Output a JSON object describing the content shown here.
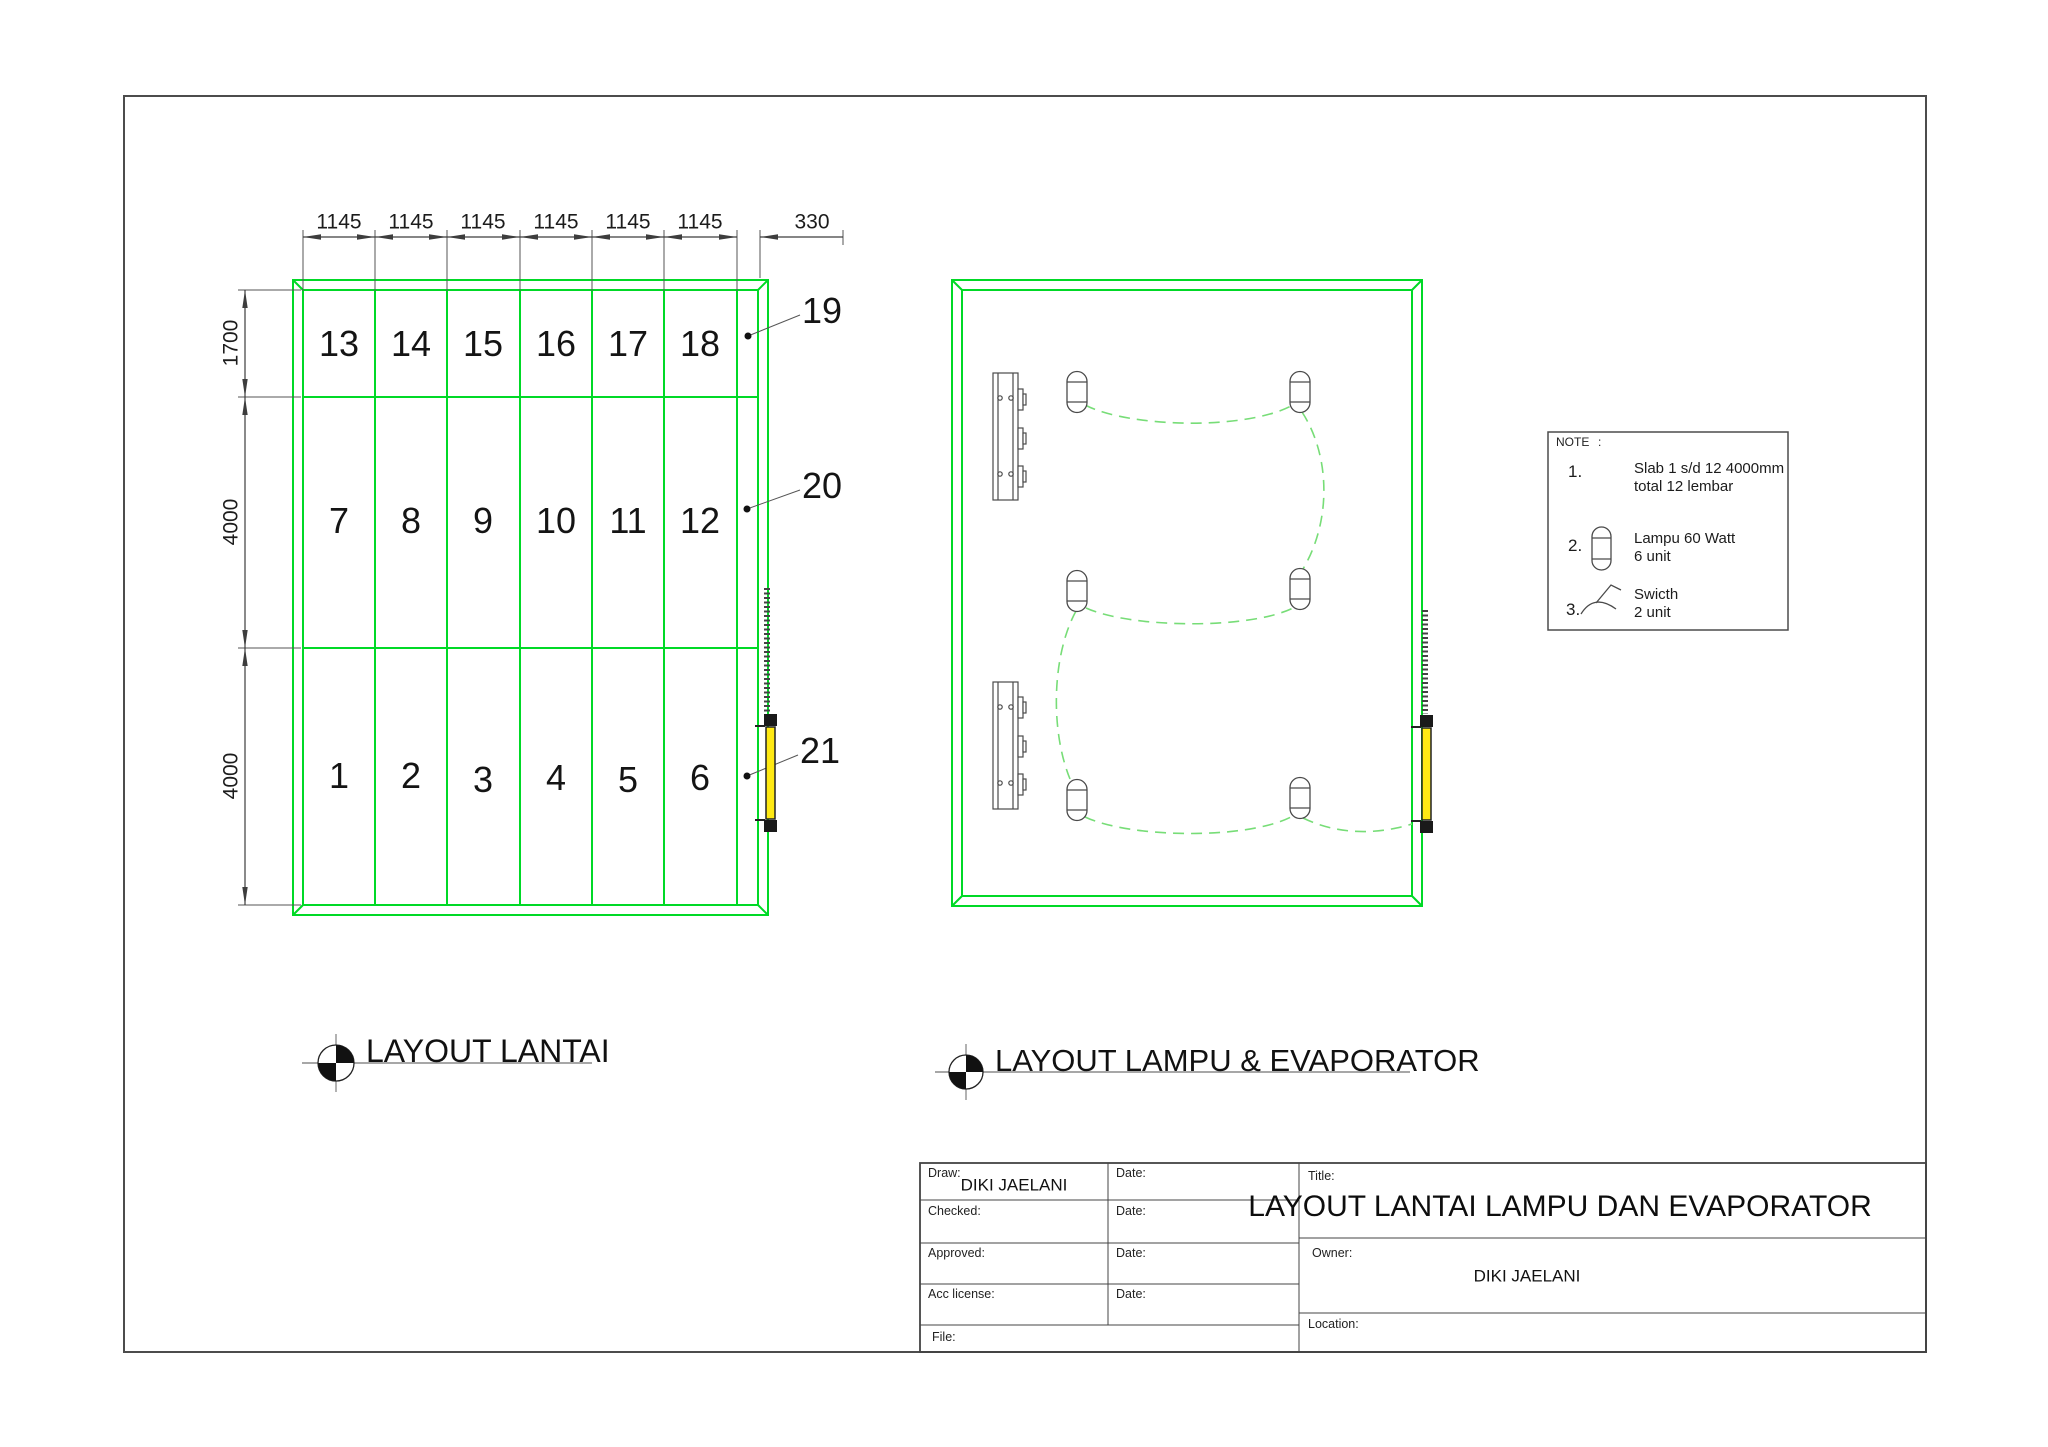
{
  "drawing1": {
    "title": "LAYOUT LANTAI",
    "top_dims": [
      "1145",
      "1145",
      "1145",
      "1145",
      "1145",
      "1145"
    ],
    "side_dim": "330",
    "left_dims": [
      "1700",
      "4000",
      "4000"
    ],
    "cells_row1": [
      "13",
      "14",
      "15",
      "16",
      "17",
      "18"
    ],
    "cells_row2": [
      "7",
      "8",
      "9",
      "10",
      "11",
      "12"
    ],
    "cells_row3": [
      "1",
      "2",
      "3",
      "4",
      "5",
      "6"
    ],
    "callouts": [
      "19",
      "20",
      "21"
    ]
  },
  "drawing2": {
    "title": "LAYOUT LAMPU & EVAPORATOR"
  },
  "note": {
    "label": "NOTE",
    "colon": ":",
    "items": [
      {
        "no": "1.",
        "line1": "Slab 1 s/d 12 4000mm",
        "line2": "total 12 lembar"
      },
      {
        "no": "2.",
        "line1": "Lampu 60 Watt",
        "line2": "6 unit"
      },
      {
        "no": "3.",
        "line1": "Swicth",
        "line2": "2 unit"
      }
    ]
  },
  "titleblock": {
    "draw_label": "Draw:",
    "draw_value": "DIKI JAELANI",
    "checked_label": "Checked:",
    "approved_label": "Approved:",
    "acc_label": "Acc license:",
    "file_label": "File:",
    "date_label": "Date:",
    "title_label": "Title:",
    "title_value": "LAYOUT LANTAI LAMPU DAN EVAPORATOR",
    "owner_label": "Owner:",
    "owner_value": "DIKI JAELANI",
    "location_label": "Location:"
  },
  "colors": {
    "green": "#00d926",
    "wire_green": "#77dd77",
    "door_yellow": "#ffe913",
    "ink": "#3d3d3d"
  }
}
